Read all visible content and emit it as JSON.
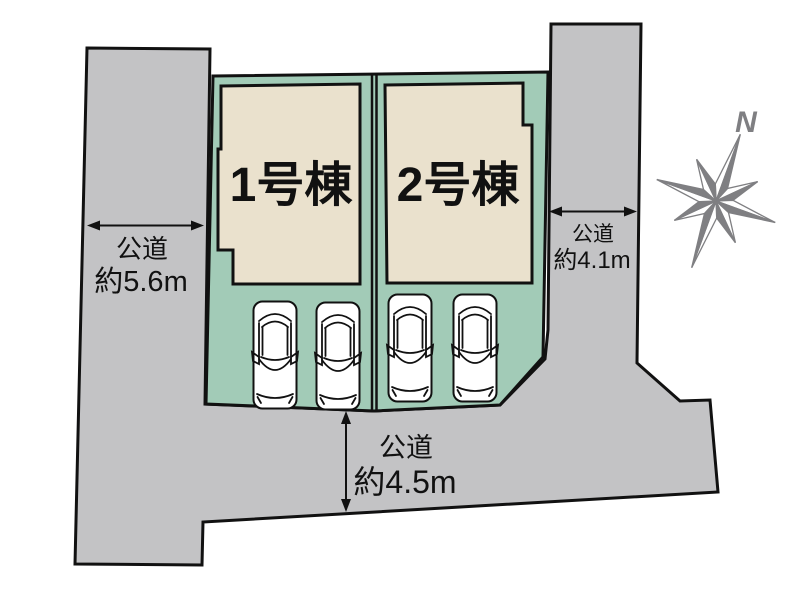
{
  "plan": {
    "buildings": [
      {
        "label": "1号棟"
      },
      {
        "label": "2号棟"
      }
    ],
    "roads": {
      "left": {
        "line1": "公道",
        "line2": "約5.6m"
      },
      "right": {
        "line1": "公道",
        "line2": "約4.1m"
      },
      "bottom": {
        "line1": "公道",
        "line2": "約4.5m"
      }
    },
    "compass": {
      "label": "N"
    },
    "cars_count": 4,
    "colors": {
      "road": "#c3c3c5",
      "lot": "#a2cbb7",
      "building": "#eae1cd",
      "outline": "#111111",
      "compass": "#7f7f82",
      "car_fill": "#ffffff"
    }
  }
}
